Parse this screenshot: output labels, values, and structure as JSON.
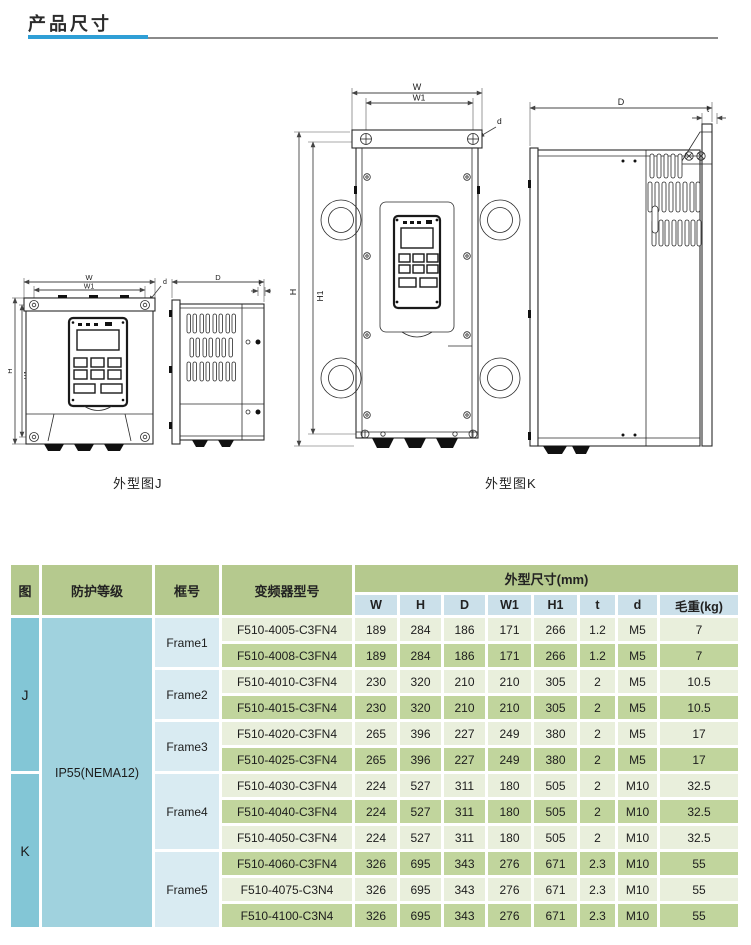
{
  "page": {
    "title": "产品尺寸"
  },
  "colors": {
    "accent_blue": "#2f9fd6",
    "rule_gray": "#8a8a8a",
    "header_green": "#b5c98e",
    "subheader_blue": "#cbe0ea",
    "fig_col_blue": "#83c6d6",
    "protection_blue": "#a0d2de",
    "frame_blue": "#d9ebf2",
    "row_light": "#e9efdc",
    "row_dark": "#c1d59d"
  },
  "figures": {
    "j": {
      "caption": "外型图J",
      "labels": {
        "w": "W",
        "w1": "W1",
        "h": "H",
        "h1": "H1",
        "depth": "D",
        "t": "t",
        "d": "d"
      }
    },
    "k": {
      "caption": "外型图K",
      "labels": {
        "w": "W",
        "w1": "W1",
        "h": "H",
        "h1": "H1",
        "depth": "D",
        "t": "t",
        "d": "d"
      }
    }
  },
  "table": {
    "header": {
      "fig": "图",
      "protection": "防护等级",
      "frame": "框号",
      "model": "变频器型号",
      "dims_group": "外型尺寸(mm)"
    },
    "dim_cols": [
      "W",
      "H",
      "D",
      "W1",
      "H1",
      "t",
      "d",
      "毛重(kg)"
    ],
    "fig_groups": [
      {
        "label": "J"
      },
      {
        "label": "K"
      }
    ],
    "protection_value": "IP55(NEMA12)",
    "frames": [
      {
        "label": "Frame1"
      },
      {
        "label": "Frame2"
      },
      {
        "label": "Frame3"
      },
      {
        "label": "Frame4"
      },
      {
        "label": "Frame5"
      }
    ],
    "rows": [
      {
        "model": "F510-4005-C3FN4",
        "values": [
          "189",
          "284",
          "186",
          "171",
          "266",
          "1.2",
          "M5",
          "7"
        ]
      },
      {
        "model": "F510-4008-C3FN4",
        "values": [
          "189",
          "284",
          "186",
          "171",
          "266",
          "1.2",
          "M5",
          "7"
        ]
      },
      {
        "model": "F510-4010-C3FN4",
        "values": [
          "230",
          "320",
          "210",
          "210",
          "305",
          "2",
          "M5",
          "10.5"
        ]
      },
      {
        "model": "F510-4015-C3FN4",
        "values": [
          "230",
          "320",
          "210",
          "210",
          "305",
          "2",
          "M5",
          "10.5"
        ]
      },
      {
        "model": "F510-4020-C3FN4",
        "values": [
          "265",
          "396",
          "227",
          "249",
          "380",
          "2",
          "M5",
          "17"
        ]
      },
      {
        "model": "F510-4025-C3FN4",
        "values": [
          "265",
          "396",
          "227",
          "249",
          "380",
          "2",
          "M5",
          "17"
        ]
      },
      {
        "model": "F510-4030-C3FN4",
        "values": [
          "224",
          "527",
          "311",
          "180",
          "505",
          "2",
          "M10",
          "32.5"
        ]
      },
      {
        "model": "F510-4040-C3FN4",
        "values": [
          "224",
          "527",
          "311",
          "180",
          "505",
          "2",
          "M10",
          "32.5"
        ]
      },
      {
        "model": "F510-4050-C3FN4",
        "values": [
          "224",
          "527",
          "311",
          "180",
          "505",
          "2",
          "M10",
          "32.5"
        ]
      },
      {
        "model": "F510-4060-C3FN4",
        "values": [
          "326",
          "695",
          "343",
          "276",
          "671",
          "2.3",
          "M10",
          "55"
        ]
      },
      {
        "model": "F510-4075-C3N4",
        "values": [
          "326",
          "695",
          "343",
          "276",
          "671",
          "2.3",
          "M10",
          "55"
        ]
      },
      {
        "model": "F510-4100-C3N4",
        "values": [
          "326",
          "695",
          "343",
          "276",
          "671",
          "2.3",
          "M10",
          "55"
        ]
      }
    ]
  }
}
